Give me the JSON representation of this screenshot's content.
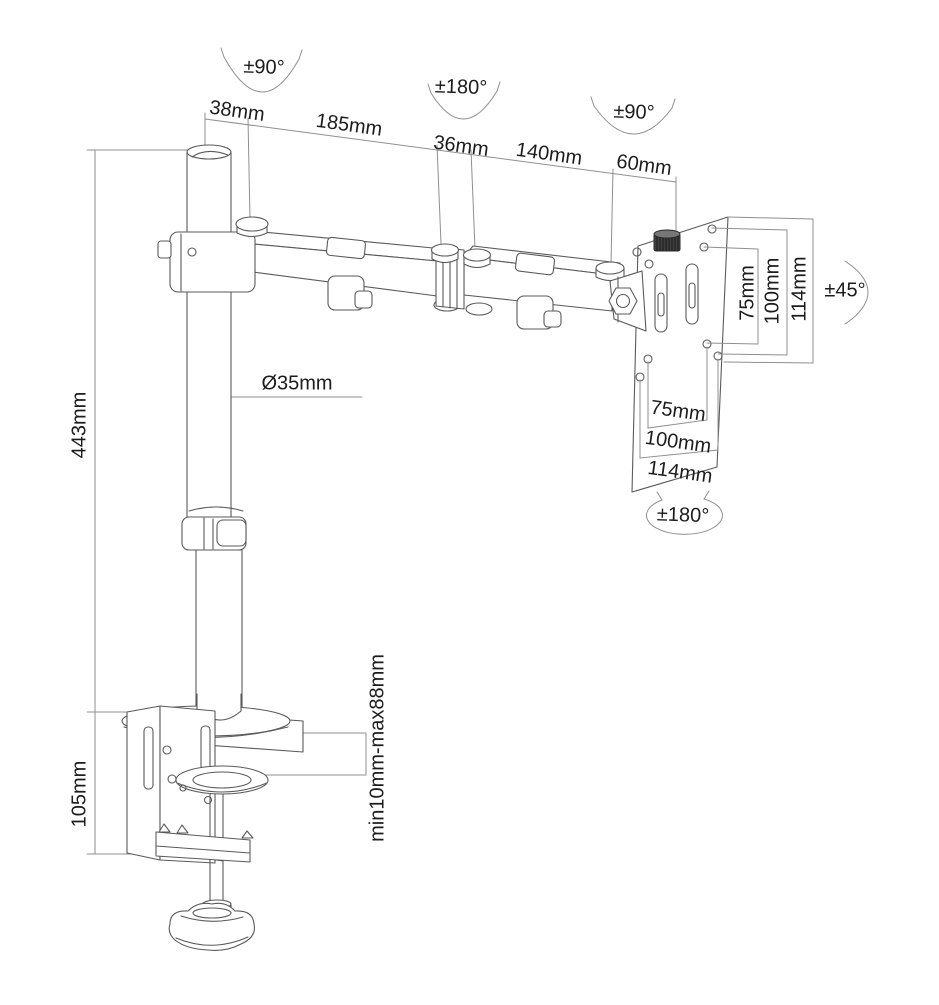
{
  "labels": {
    "pole_swivel": "±90°",
    "pole_top_width": "38mm",
    "arm1_length": "185mm",
    "mid_joint_swivel": "±180°",
    "mid_joint_width": "36mm",
    "arm2_length": "140mm",
    "head_swivel": "±90°",
    "head_width": "60mm",
    "pole_diameter": "Ø35mm",
    "pole_height": "443mm",
    "clamp_height": "105mm",
    "clamp_range": "min10mm-max88mm",
    "tilt_range": "±45°",
    "vesa_rotation": "±180°",
    "vesa_vertical": [
      "75mm",
      "100mm",
      "114mm"
    ],
    "vesa_horizontal": [
      "75mm",
      "100mm",
      "114mm"
    ]
  },
  "colors": {
    "part_line": "#5a5a5a",
    "dim_line": "#8f8f8f",
    "text": "#1c1c1c",
    "knob_fill": "#3f3f3f",
    "background": "#ffffff"
  }
}
